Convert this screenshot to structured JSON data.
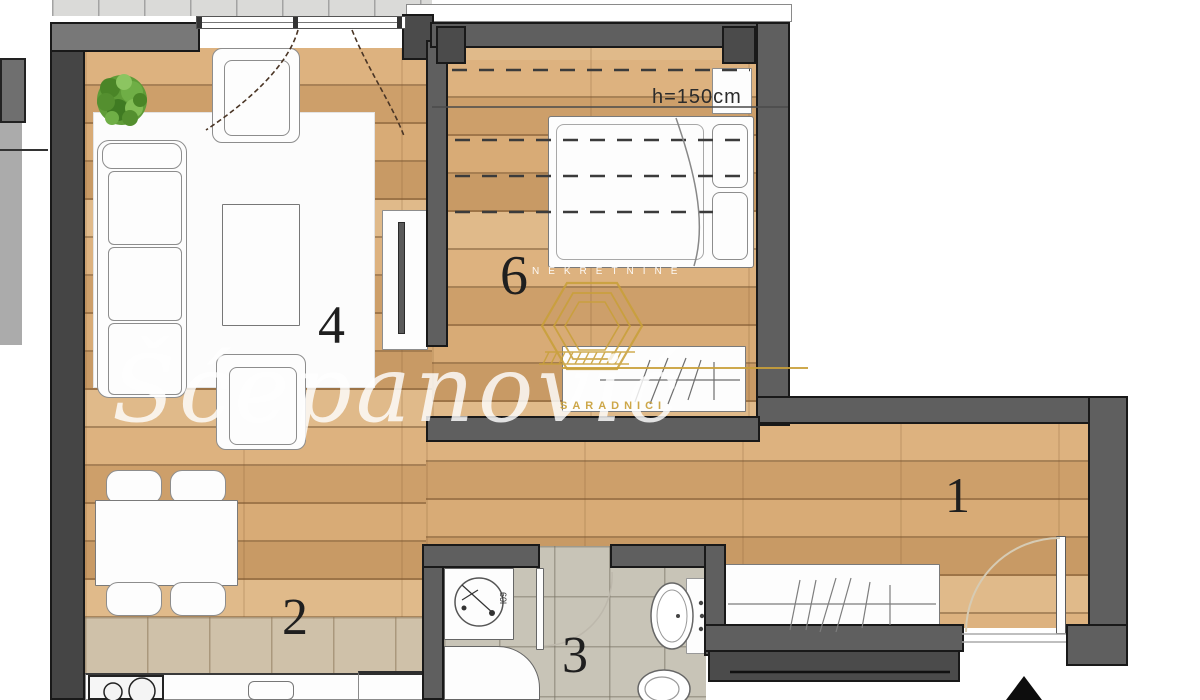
{
  "watermark": {
    "top": "NEKRETNINE",
    "script": "Šćepanović",
    "bottom": "SARADNICI"
  },
  "rooms": {
    "hallway": "1",
    "dining": "2",
    "bathroom": "3",
    "living": "4",
    "bedroom": "6"
  },
  "annotations": {
    "height_label": "h=150cm",
    "washer_label": "60l"
  },
  "colors": {
    "wall": "#5f5f5f",
    "wood": "#d3a571",
    "gold": "#c9a03a",
    "kitchen_tile": "#cfc1a9",
    "bath_tile": "#c8c4b7"
  }
}
